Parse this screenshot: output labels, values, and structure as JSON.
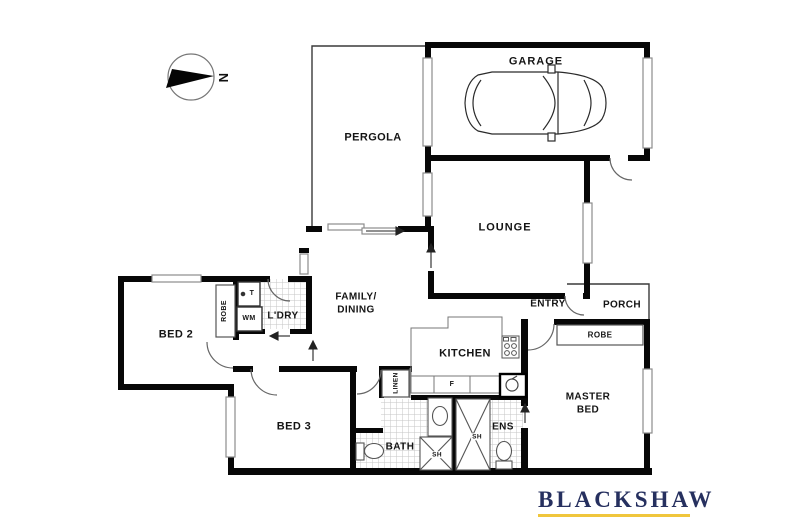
{
  "compass": {
    "north": "N"
  },
  "rooms": {
    "pergola": "PERGOLA",
    "garage": "GARAGE",
    "lounge": "LOUNGE",
    "family1": "FAMILY/",
    "family2": "DINING",
    "kitchen": "KITCHEN",
    "entry": "ENTRY",
    "porch": "PORCH",
    "laundry": "L'DRY",
    "bed2": "BED 2",
    "bed3": "BED 3",
    "bath": "BATH",
    "ens": "ENS",
    "master1": "MASTER",
    "master2": "BED"
  },
  "fixtures": {
    "robe_bed2": "ROBE",
    "robe_master": "ROBE",
    "linen": "LINEN",
    "wm": "WM",
    "trough": "T",
    "fridge": "F",
    "shower_bath": "SH",
    "shower_ens": "SH"
  },
  "branding": {
    "agency": "BLACKSHAW",
    "navy": "#26305f",
    "gold": "#f0c63c"
  }
}
